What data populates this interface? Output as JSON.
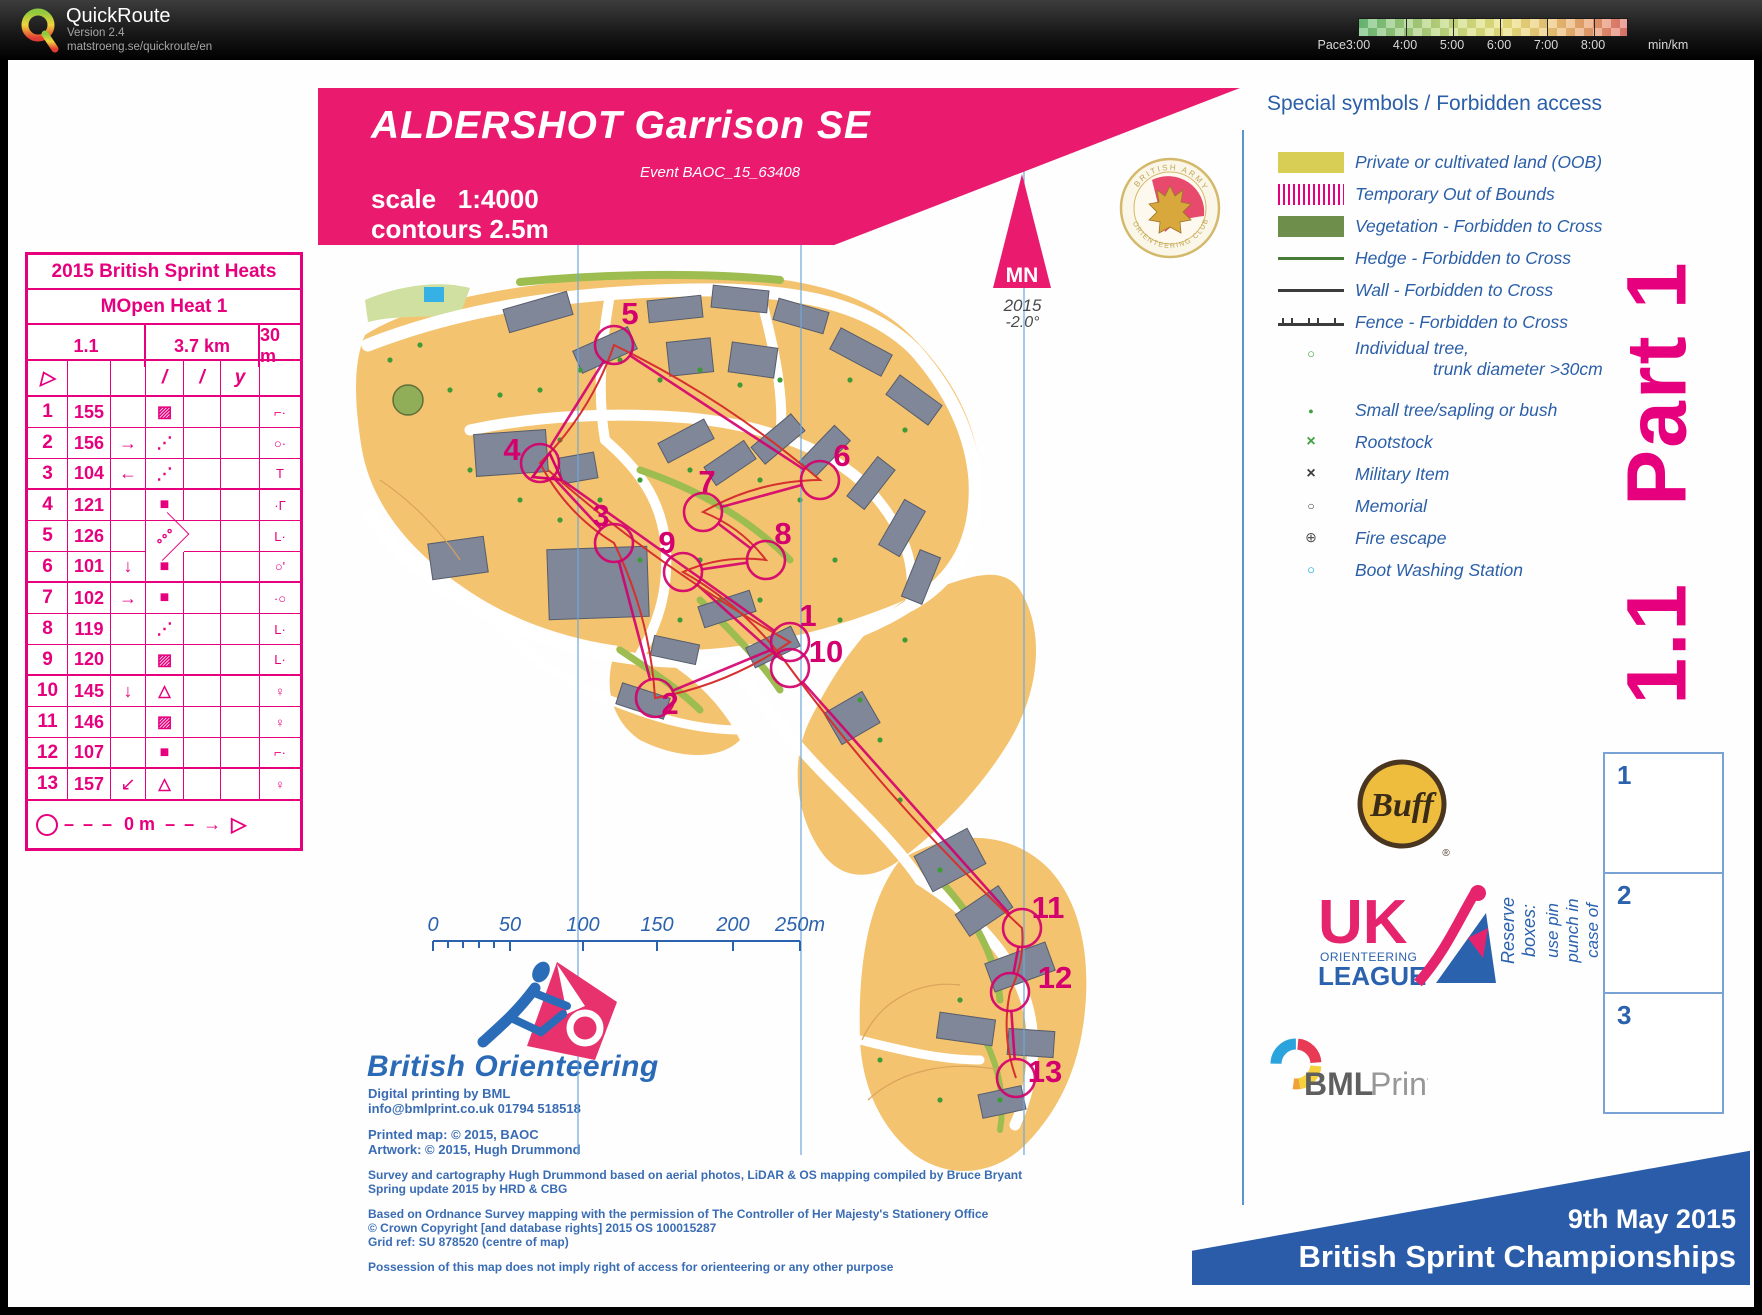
{
  "app": {
    "name": "QuickRoute",
    "version": "Version 2.4",
    "url": "matstroeng.se/quickroute/en",
    "pace": {
      "label": "Pace",
      "unit": "min/km",
      "ticks": [
        {
          "t": "3:00",
          "x": 1358
        },
        {
          "t": "4:00",
          "x": 1405
        },
        {
          "t": "5:00",
          "x": 1452
        },
        {
          "t": "6:00",
          "x": 1499
        },
        {
          "t": "7:00",
          "x": 1546
        },
        {
          "t": "8:00",
          "x": 1593
        }
      ],
      "gradient_colors": [
        "#6abc78",
        "#9ecb7a",
        "#cfdd7e",
        "#ece07e",
        "#ecc474",
        "#e89d6c",
        "#e2766e"
      ]
    }
  },
  "control_card": {
    "title": "2015 British Sprint Heats",
    "subtitle": "MOpen Heat 1",
    "course_number": "1.1",
    "length": "3.7 km",
    "climb": "30 m",
    "header_syms": [
      "▷",
      "",
      "",
      "/",
      "/",
      "y",
      ""
    ],
    "rows": [
      {
        "n": "1",
        "code": "155",
        "c": "",
        "d": "▨",
        "g": "⌐·"
      },
      {
        "n": "2",
        "code": "156",
        "c": "→",
        "d": "⋰",
        "g": "○·"
      },
      {
        "n": "3",
        "code": "104",
        "c": "←",
        "d": "⋰",
        "g": "T"
      },
      {
        "n": "4",
        "code": "121",
        "c": "",
        "d": "■",
        "g": "·Γ"
      },
      {
        "n": "5",
        "code": "126",
        "c": "",
        "d": "∘∘∘",
        "g": "L·"
      },
      {
        "n": "6",
        "code": "101",
        "c": "↓",
        "d": "■",
        "g": "○'"
      },
      {
        "n": "7",
        "code": "102",
        "c": "→",
        "d": "■",
        "g": "·○"
      },
      {
        "n": "8",
        "code": "119",
        "c": "",
        "d": "⋰",
        "g": "L·"
      },
      {
        "n": "9",
        "code": "120",
        "c": "",
        "d": "▨",
        "g": "L·"
      },
      {
        "n": "10",
        "code": "145",
        "c": "↓",
        "d": "△",
        "g": "♀"
      },
      {
        "n": "11",
        "code": "146",
        "c": "",
        "d": "▨",
        "g": "♀"
      },
      {
        "n": "12",
        "code": "107",
        "c": "",
        "d": "■",
        "g": "⌐·"
      },
      {
        "n": "13",
        "code": "157",
        "c": "↙",
        "d": "△",
        "g": "♀"
      }
    ],
    "finish": {
      "dash1": "– – –",
      "dist": "0 m",
      "dash2": "– – →",
      "tri": "▷"
    }
  },
  "map_banner": {
    "title": "ALDERSHOT Garrison SE",
    "event": "Event BAOC_15_63408",
    "scale": "scale   1:4000",
    "contours": "contours 2.5m",
    "color": "#ea1a6e"
  },
  "north": {
    "label": "MN",
    "year": "2015",
    "decl": "-2.0°"
  },
  "badge": {
    "top": "BRITISH ARMY",
    "bottom": "ORIENTEERING CLUB"
  },
  "legend": {
    "title": "Special symbols / Forbidden access",
    "items": [
      {
        "swatch": "oob",
        "label": "Private or cultivated land (OOB)"
      },
      {
        "swatch": "toob",
        "label": "Temporary Out of Bounds"
      },
      {
        "swatch": "veg",
        "label": "Vegetation - Forbidden to Cross"
      },
      {
        "swatch": "hedge",
        "label": "Hedge - Forbidden to Cross"
      },
      {
        "swatch": "wall",
        "label": "Wall - Forbidden to Cross"
      },
      {
        "swatch": "fence",
        "label": "Fence - Forbidden to Cross"
      },
      {
        "swatch": "tree",
        "label": "Individual tree,",
        "label2": "trunk diameter >30cm"
      },
      {
        "swatch": "smalltree",
        "label": "Small tree/sapling or bush"
      },
      {
        "swatch": "rootstock",
        "label": "Rootstock"
      },
      {
        "swatch": "military",
        "label": "Military Item"
      },
      {
        "swatch": "memorial",
        "label": "Memorial"
      },
      {
        "swatch": "fire",
        "label": "Fire escape"
      },
      {
        "swatch": "boot",
        "label": "Boot Washing Station"
      }
    ]
  },
  "part_label": "1.1   Part 1",
  "course": {
    "color": "#d4006d",
    "route_color": "#d63030",
    "start": {
      "x": 548,
      "y": 470
    },
    "controls": [
      {
        "n": "1",
        "x": 790,
        "y": 642,
        "lx": 808,
        "ly": 626
      },
      {
        "n": "2",
        "x": 655,
        "y": 698,
        "lx": 670,
        "ly": 714
      },
      {
        "n": "3",
        "x": 614,
        "y": 543,
        "lx": 601,
        "ly": 526
      },
      {
        "n": "4",
        "x": 540,
        "y": 463,
        "lx": 512,
        "ly": 460
      },
      {
        "n": "5",
        "x": 614,
        "y": 345,
        "lx": 630,
        "ly": 324
      },
      {
        "n": "6",
        "x": 820,
        "y": 480,
        "lx": 842,
        "ly": 466
      },
      {
        "n": "7",
        "x": 703,
        "y": 512,
        "lx": 707,
        "ly": 492
      },
      {
        "n": "8",
        "x": 766,
        "y": 560,
        "lx": 783,
        "ly": 544
      },
      {
        "n": "9",
        "x": 683,
        "y": 572,
        "lx": 667,
        "ly": 553
      },
      {
        "n": "10",
        "x": 790,
        "y": 668,
        "lx": 826,
        "ly": 662
      },
      {
        "n": "11",
        "x": 1022,
        "y": 928,
        "lx": 1048,
        "ly": 918
      },
      {
        "n": "12",
        "x": 1010,
        "y": 992,
        "lx": 1055,
        "ly": 988
      },
      {
        "n": "13",
        "x": 1016,
        "y": 1078,
        "lx": 1045,
        "ly": 1082
      }
    ]
  },
  "scale_bar": {
    "labels": [
      {
        "t": "0",
        "x": 433
      },
      {
        "t": "50",
        "x": 510
      },
      {
        "t": "100",
        "x": 583
      },
      {
        "t": "150",
        "x": 657
      },
      {
        "t": "200",
        "x": 733
      },
      {
        "t": "250m",
        "x": 800
      }
    ]
  },
  "reserve": {
    "line1": "Reserve boxes:",
    "line2": "use pin punch in case of e-punch failure",
    "boxes": [
      "1",
      "2",
      "3"
    ]
  },
  "event_banner": {
    "date": "9th May 2015",
    "title": "British Sprint Championships"
  },
  "logos": {
    "buff": "Buff",
    "reg": "®",
    "uk": "UK",
    "uk_line1": "ORIENTEERING",
    "uk_line2": "LEAGUE",
    "bml_bold": "BML",
    "bml_light": "Print",
    "bo": "British Orienteering"
  },
  "credits": {
    "top": [
      "Digital printing by BML",
      "info@bmlprint.co.uk 01794 518518",
      "",
      "Printed map: © 2015, BAOC",
      "Artwork: © 2015, Hugh Drummond"
    ],
    "legal": [
      "Survey and cartography Hugh Drummond based on aerial photos, LiDAR & OS mapping compiled by Bruce Bryant",
      "Spring update 2015 by HRD & CBG",
      "",
      "Based on Ordnance Survey mapping  with the permission of The Controller  of Her Majesty's Stationery Office",
      "© Crown Copyright [and database rights] 2015 OS 100015287",
      "Grid ref: SU 878520 (centre of map)",
      "",
      "Possession of this map does not imply right of  access  for orienteering or any other purpose"
    ]
  }
}
